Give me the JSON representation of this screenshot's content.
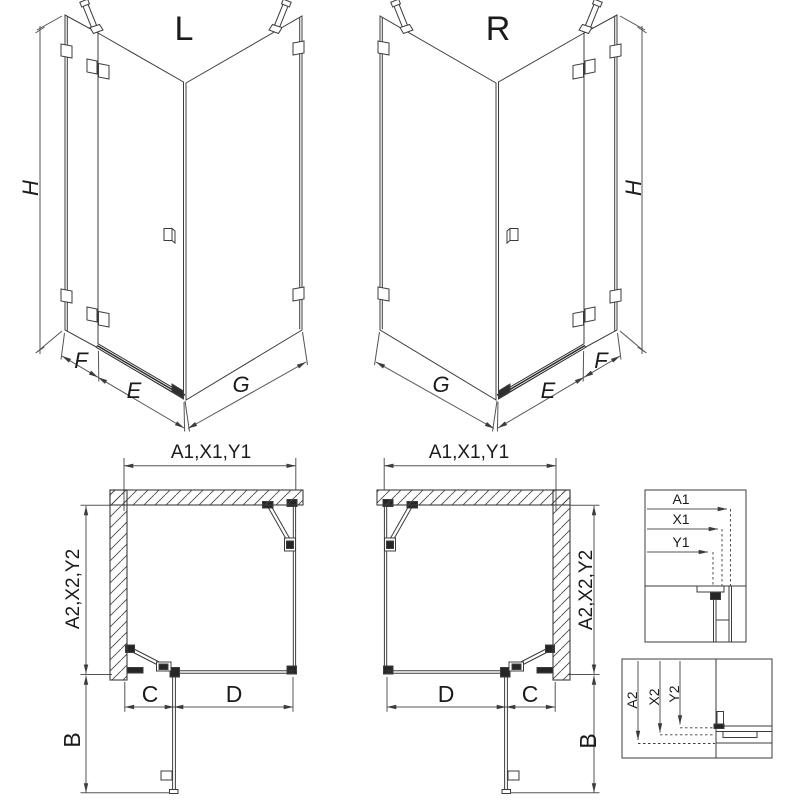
{
  "colors": {
    "background": "#ffffff",
    "line": "#3c3c3c",
    "dim_line": "#555555",
    "dark_fitting": "#262626",
    "text": "#1b1b1b"
  },
  "view_3d_left": {
    "title": "L",
    "h": "H",
    "f": "F",
    "e": "E",
    "g": "G"
  },
  "view_3d_right": {
    "title": "R",
    "h": "H",
    "f": "F",
    "e": "E",
    "g": "G"
  },
  "plan_left": {
    "top": "A1,X1,Y1",
    "side": "A2,X2,Y2",
    "c": "C",
    "d": "D",
    "b": "B"
  },
  "plan_right": {
    "top": "A1,X1,Y1",
    "side": "A2,X2,Y2",
    "c": "C",
    "d": "D",
    "b": "B"
  },
  "detail_width": {
    "a1": "A1",
    "x1": "X1",
    "y1": "Y1"
  },
  "detail_depth": {
    "a2": "A2",
    "x2": "X2",
    "y2": "Y2"
  }
}
